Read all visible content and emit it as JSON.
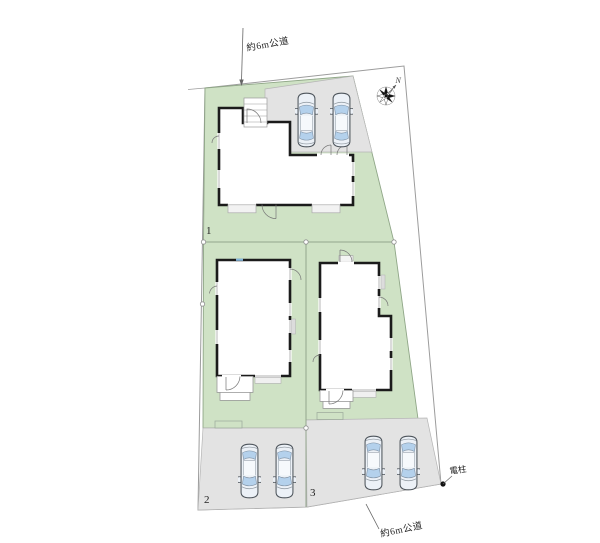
{
  "site": {
    "type": "residential-site-plan",
    "labels": {
      "road_top": "約6m公道",
      "road_bottom": "約6m公道",
      "utility_pole": "電柱",
      "north": "N"
    },
    "plots": [
      {
        "number": "1",
        "cars_parked": 2,
        "parking_side": "top"
      },
      {
        "number": "2",
        "cars_parked": 2,
        "parking_side": "bottom"
      },
      {
        "number": "3",
        "cars_parked": 2,
        "parking_side": "bottom"
      }
    ],
    "colors": {
      "plot_green": "#cfe2c5",
      "plot_border": "#8fa687",
      "parking_gray": "#e3e3e3",
      "parking_border": "#b5b5b5",
      "house_fill": "#ffffff",
      "house_wall": "#1b1b1b",
      "boundary_line": "#9c9c9c",
      "car_body": "#ecf1f7",
      "car_window": "#b4d1ec",
      "car_outline": "#4e555c"
    }
  }
}
